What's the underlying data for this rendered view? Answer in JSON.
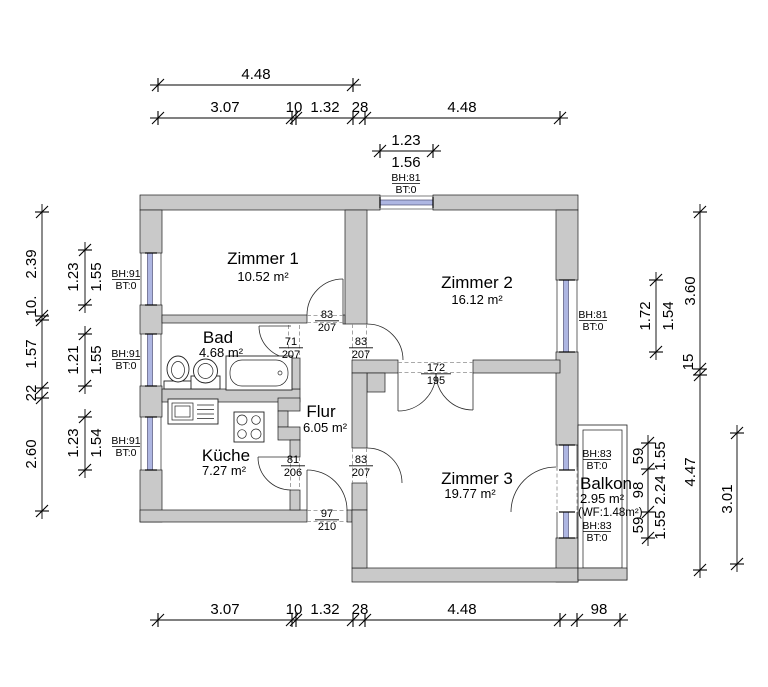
{
  "rooms": {
    "zimmer1": {
      "name": "Zimmer 1",
      "area": "10.52 m²"
    },
    "zimmer2": {
      "name": "Zimmer 2",
      "area": "16.12 m²"
    },
    "zimmer3": {
      "name": "Zimmer 3",
      "area": "19.77 m²"
    },
    "bad": {
      "name": "Bad",
      "area": "4.68 m²"
    },
    "kueche": {
      "name": "Küche",
      "area": "7.27 m²"
    },
    "flur": {
      "name": "Flur",
      "area": "6.05 m²"
    },
    "balkon": {
      "name": "Balkon",
      "area": "2.95 m²",
      "note": "(WF:1.48m²)"
    }
  },
  "doors": {
    "zimmer1_door": {
      "w": "83",
      "h": "207"
    },
    "bad_door": {
      "w": "71",
      "h": "207"
    },
    "zimmer2_door": {
      "w": "83",
      "h": "207"
    },
    "zimmer2_opening": {
      "w": "172",
      "h": "195"
    },
    "kueche_door": {
      "w": "81",
      "h": "206"
    },
    "zimmer3_door": {
      "w": "83",
      "h": "207"
    },
    "entrance_door": {
      "w": "97",
      "h": "210"
    }
  },
  "windows": {
    "top": {
      "bh": "BH:81",
      "bt": "BT:0"
    },
    "left1": {
      "bh": "BH:91",
      "bt": "BT:0"
    },
    "left2": {
      "bh": "BH:91",
      "bt": "BT:0"
    },
    "left3": {
      "bh": "BH:91",
      "bt": "BT:0"
    },
    "right": {
      "bh": "BH:81",
      "bt": "BT:0"
    },
    "balcony_top": {
      "bh": "BH:83",
      "bt": "BT:0"
    },
    "balcony_bottom": {
      "bh": "BH:83",
      "bt": "BT:0"
    }
  },
  "dims": {
    "top": {
      "total": "4.48",
      "chain": [
        "3.07",
        "10",
        "1.32",
        "28",
        "4.48"
      ],
      "win_a": "1.23",
      "win_b": "1.56"
    },
    "bottom": {
      "chain": [
        "3.07",
        "10",
        "1.32",
        "28",
        "4.48"
      ],
      "balcony": "98"
    },
    "left": {
      "chain": [
        "2.39",
        "10.",
        "1.57",
        "22",
        "2.60"
      ],
      "win1": {
        "a": "1.23",
        "b": "1.55"
      },
      "win2": {
        "a": "1.21",
        "b": "1.55"
      },
      "win3": {
        "a": "1.23",
        "b": "1.54"
      }
    },
    "right": {
      "chain": [
        "3.60",
        "15",
        "4.47"
      ],
      "balcony_total": "3.01",
      "win": {
        "a": "1.72",
        "b": "1.54"
      },
      "balcony_chain": [
        {
          "a": "59",
          "b": "1.55"
        },
        {
          "a": "98",
          "b": "2.24"
        },
        {
          "a": "59",
          "b": "1.55"
        }
      ]
    }
  },
  "colors": {
    "wall": "#c9c9c9",
    "glass": "#aeb6e2",
    "line": "#000000",
    "dashed": "#8d8d8d"
  }
}
